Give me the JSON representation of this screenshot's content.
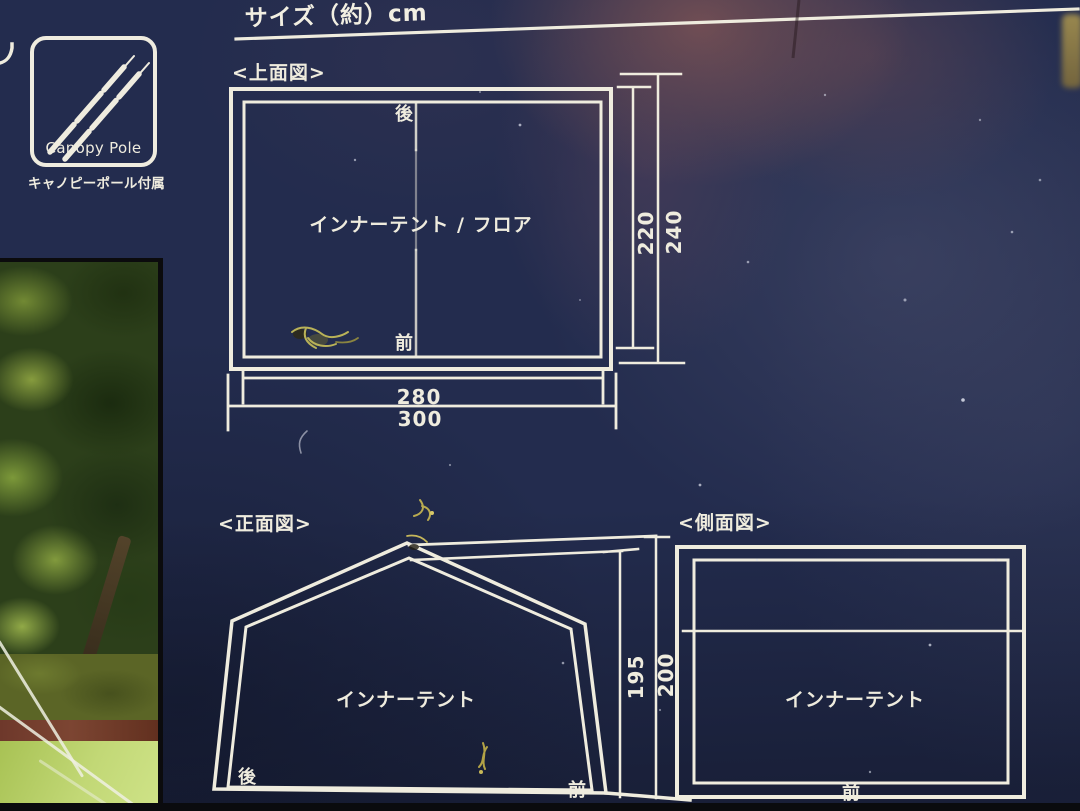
{
  "title": "サイズ（約）cm",
  "canopy": {
    "icon": "canopy-pole-icon",
    "label": "Canopy Pole",
    "caption": "キャノピーポール付属"
  },
  "diagrams": {
    "top_view": {
      "title": "<上面図>",
      "back": "後",
      "front": "前",
      "area": "インナーテント / フロア",
      "inner_depth": "220",
      "outer_depth": "240",
      "inner_width": "280",
      "outer_width": "300"
    },
    "front_view": {
      "title": "<正面図>",
      "area": "インナーテント",
      "back": "後",
      "front": "前",
      "inner_height": "195",
      "outer_height": "200"
    },
    "side_view": {
      "title": "<側面図>",
      "area": "インナーテント",
      "front": "前"
    }
  },
  "colors": {
    "card_navy": "#232C4E",
    "line_white": "#EFECDE",
    "maroon_tint": "#76504F",
    "photo_foliage": "#2C3F1A",
    "photo_lawn": "#BFD671",
    "photo_brick": "#6E382B",
    "edge_black": "#0B0B0D"
  }
}
